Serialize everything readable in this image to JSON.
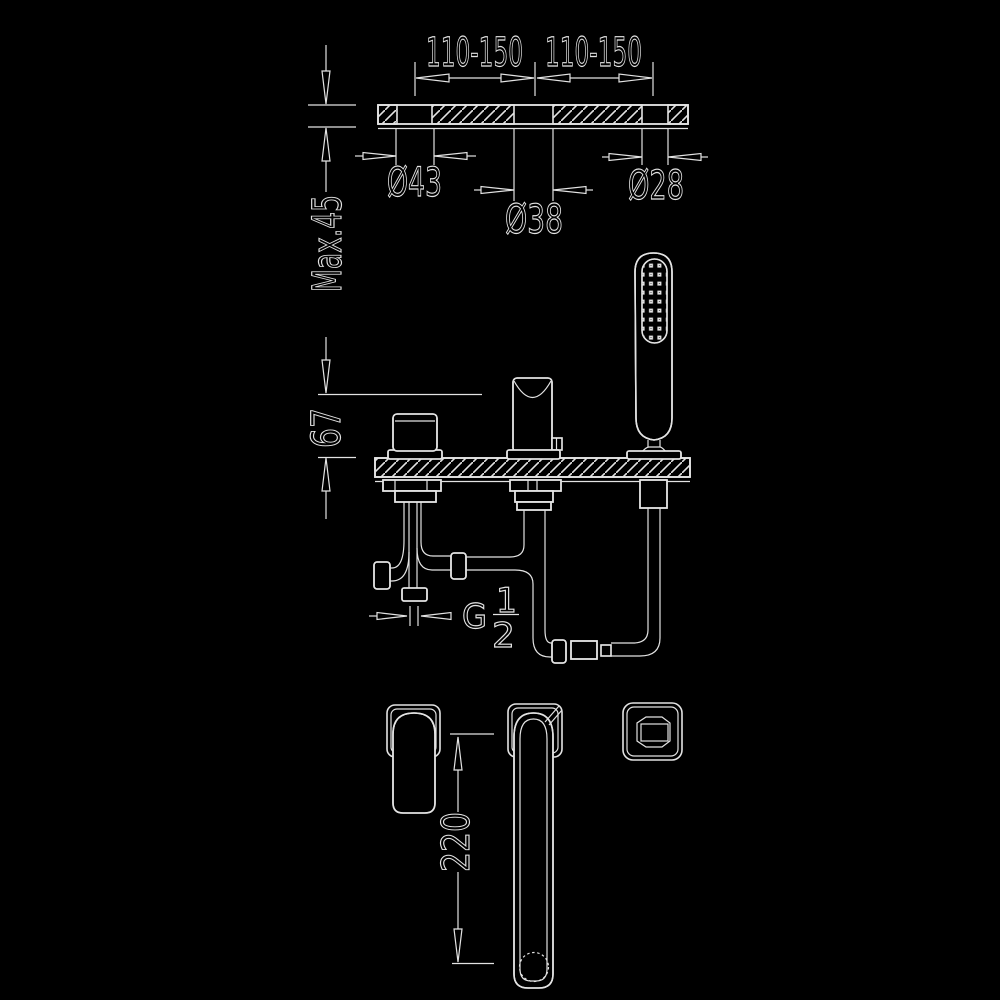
{
  "colors": {
    "background": "#000000",
    "line": "#e3e3e3"
  },
  "dimensions": {
    "span_left": "110-150",
    "span_right": "110-150",
    "hole_left_diameter": "Ø43",
    "hole_center_diameter": "Ø38",
    "hole_right_diameter": "Ø28",
    "deck_thickness_max": "Max.45",
    "spout_height": "67",
    "thread_prefix": "G",
    "thread_numerator": "1",
    "thread_denominator": "2",
    "spout_length": "220"
  }
}
